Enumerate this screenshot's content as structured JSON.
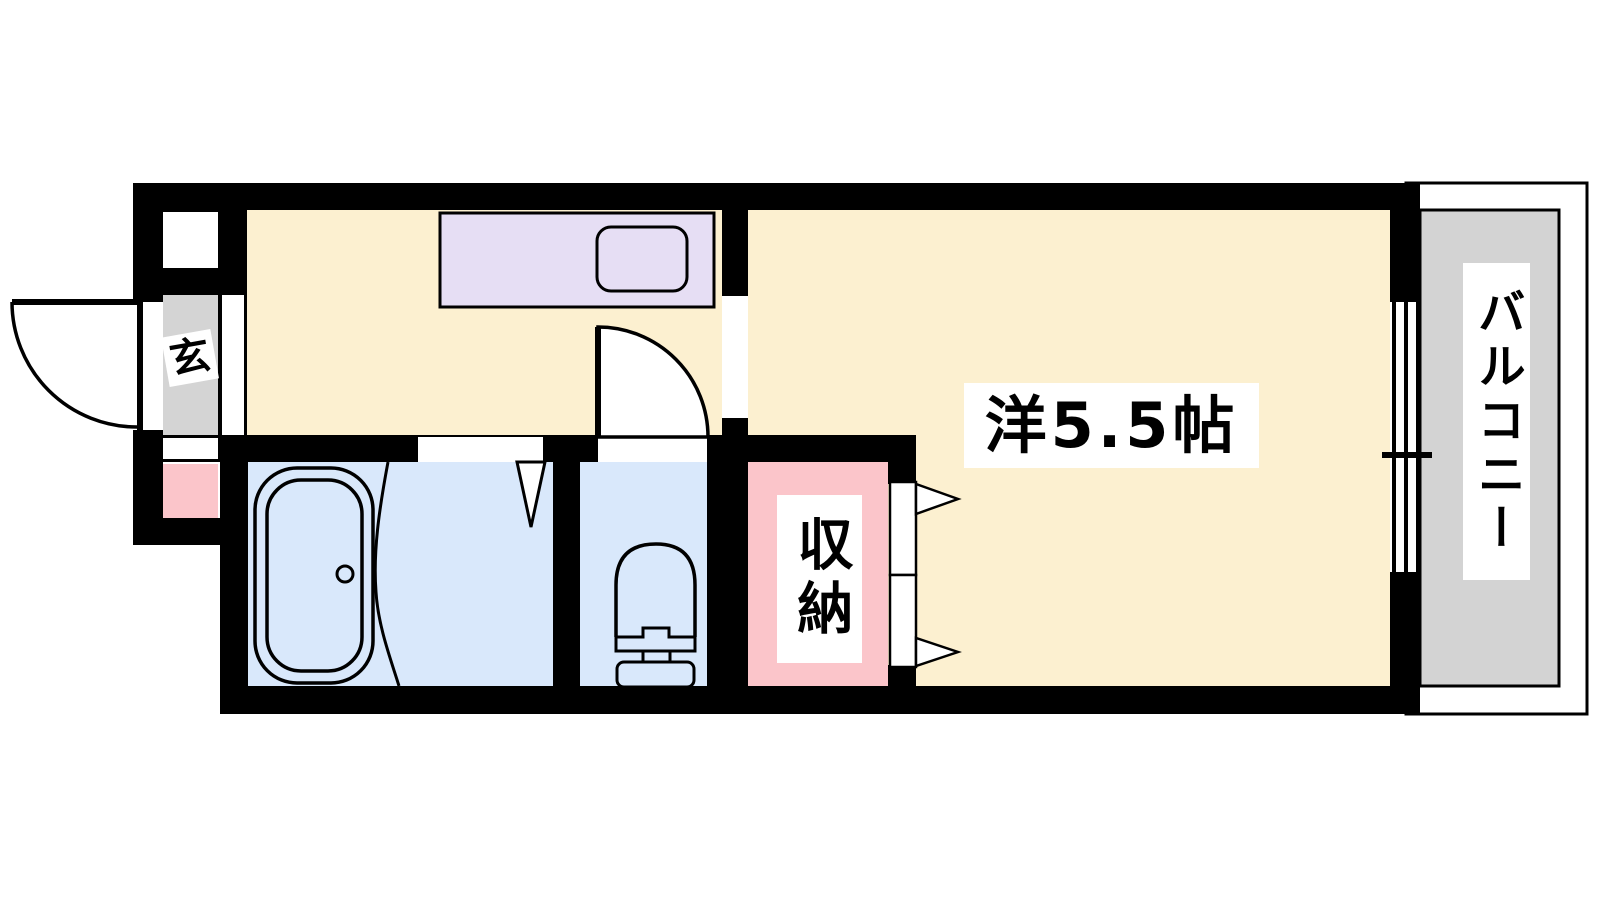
{
  "document": {
    "type": "apartment-floor-plan"
  },
  "labels": {
    "entrance": "玄",
    "western_room": "洋5.5帖",
    "storage": "収納",
    "balcony": "バルコニー"
  },
  "colors": {
    "wall": "#000000",
    "room_floor_cream": "#FCF0D0",
    "wet_area_blue": "#D9E8FB",
    "storage_pink": "#FBC5CA",
    "entrance_gray": "#D4D4D4",
    "balcony_gray": "#D3D3D3",
    "kitchen_counter_lavender": "#E6DEF4",
    "label_background": "#FFFFFF",
    "background": "#FFFFFF"
  },
  "fixture_icons": [
    "entrance-door-swing-icon",
    "interior-door-swing-icon",
    "bath-door-wedge-icon",
    "closet-folding-door-icon",
    "kitchen-counter-icon",
    "kitchen-sink-icon",
    "bathtub-icon",
    "toilet-icon",
    "sliding-window-icon"
  ]
}
